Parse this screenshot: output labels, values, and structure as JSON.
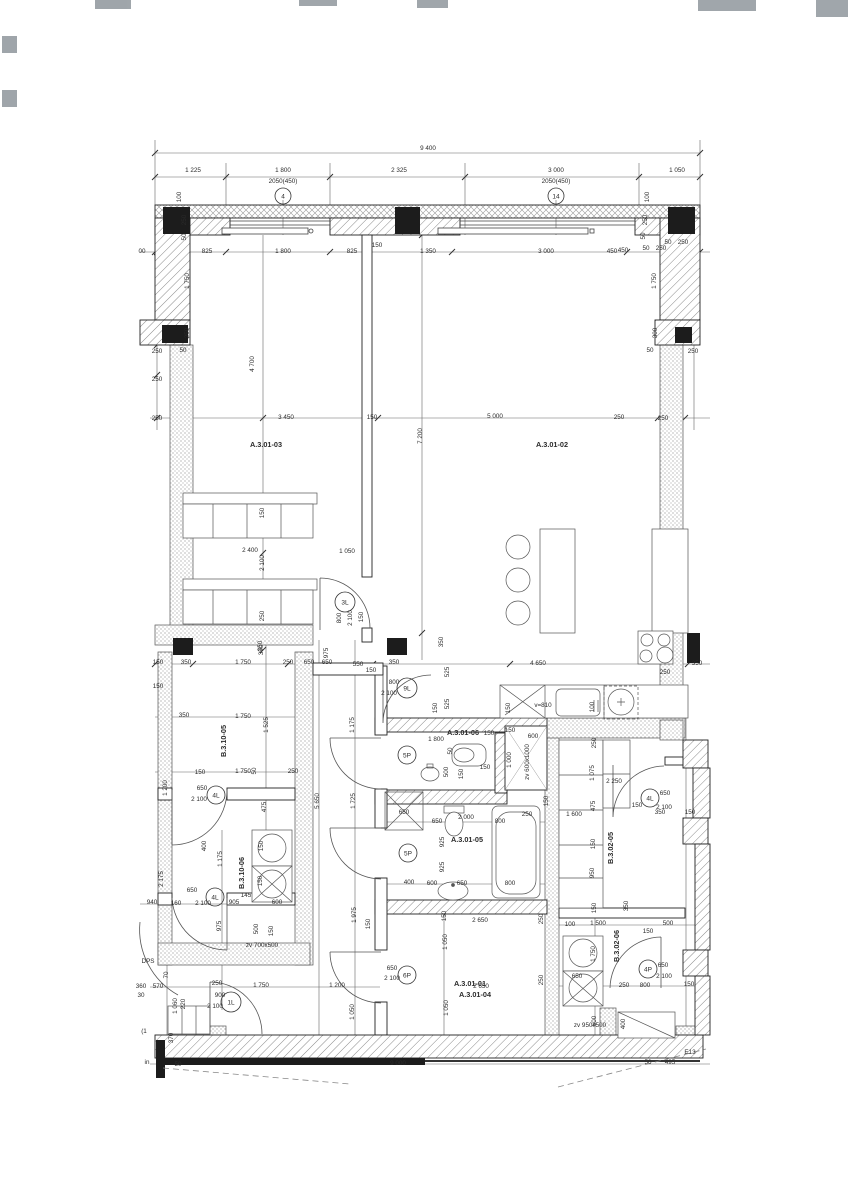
{
  "drawing": {
    "type": "architectural floor plan",
    "overall_width_top": "9 400",
    "overall_width_bottom": "9 000"
  },
  "colors": {
    "line": "#2b2b2b",
    "wall_hatch": "#8a8a8a",
    "column_fill": "#1c1c1c",
    "dim_line": "#555555"
  },
  "window_tags": [
    {
      "t": "4",
      "x": 283,
      "y": 196,
      "r": 8
    },
    {
      "t": "14",
      "x": 556,
      "y": 196,
      "r": 8
    }
  ],
  "door_tags": [
    {
      "t": "3L",
      "x": 345,
      "y": 602,
      "r": 10
    },
    {
      "t": "9L",
      "x": 407,
      "y": 688,
      "r": 10
    },
    {
      "t": "4L",
      "x": 216,
      "y": 795,
      "r": 9
    },
    {
      "t": "4L",
      "x": 215,
      "y": 897,
      "r": 9
    },
    {
      "t": "1L",
      "x": 231,
      "y": 1002,
      "r": 10
    },
    {
      "t": "5P",
      "x": 407,
      "y": 755,
      "r": 9
    },
    {
      "t": "5P",
      "x": 408,
      "y": 853,
      "r": 9
    },
    {
      "t": "6P",
      "x": 407,
      "y": 975,
      "r": 9
    },
    {
      "t": "4L",
      "x": 650,
      "y": 798,
      "r": 9
    },
    {
      "t": "4P",
      "x": 648,
      "y": 969,
      "r": 9
    }
  ],
  "room_labels": [
    {
      "t": "A.3.01-03",
      "x": 266,
      "y": 447
    },
    {
      "t": "A.3.01-02",
      "x": 552,
      "y": 447
    },
    {
      "t": "A.3.01-06",
      "x": 463,
      "y": 735
    },
    {
      "t": "A.3.01-05",
      "x": 467,
      "y": 842
    },
    {
      "t": "A.3.01-04",
      "x": 475,
      "y": 997
    },
    {
      "t": "A.3.01-01",
      "x": 470,
      "y": 986
    },
    {
      "t": "B.3.10-05",
      "x": 226,
      "y": 741,
      "v": true
    },
    {
      "t": "B.3.10-06",
      "x": 244,
      "y": 873,
      "v": true
    },
    {
      "t": "B.3.02-05",
      "x": 613,
      "y": 848,
      "v": true
    },
    {
      "t": "B.3.02-06",
      "x": 619,
      "y": 946,
      "v": true
    }
  ],
  "shaft_labels": [
    {
      "t": "zv 600x1000",
      "x": 529,
      "y": 762,
      "v": true
    },
    {
      "t": "zv 700x500",
      "x": 262,
      "y": 947
    },
    {
      "t": "zv 950x500",
      "x": 590,
      "y": 1027
    },
    {
      "t": "v=810",
      "x": 543,
      "y": 707
    }
  ],
  "dimension_labels": [
    [
      428,
      150,
      "9 400"
    ],
    [
      193,
      172,
      "1 225"
    ],
    [
      283,
      172,
      "1 800"
    ],
    [
      283,
      183,
      "2050(450)"
    ],
    [
      399,
      172,
      "2 325"
    ],
    [
      556,
      172,
      "3 000"
    ],
    [
      556,
      183,
      "2050(450)"
    ],
    [
      677,
      172,
      "1 050"
    ],
    [
      207,
      253,
      "825"
    ],
    [
      283,
      253,
      "1 800"
    ],
    [
      352,
      253,
      "825"
    ],
    [
      377,
      247,
      "150"
    ],
    [
      428,
      253,
      "1 350"
    ],
    [
      546,
      253,
      "3 000"
    ],
    [
      612,
      253,
      "450"
    ],
    [
      646,
      250,
      "50"
    ],
    [
      661,
      250,
      "250"
    ],
    [
      142,
      253,
      "00"
    ],
    [
      181,
      197,
      "100",
      "v"
    ],
    [
      186,
      220,
      "250",
      "v"
    ],
    [
      186,
      237,
      "50",
      "v"
    ],
    [
      189,
      281,
      "1 750",
      "v"
    ],
    [
      189,
      333,
      "250",
      "v"
    ],
    [
      157,
      353,
      "250"
    ],
    [
      183,
      352,
      "50"
    ],
    [
      157,
      381,
      "250"
    ],
    [
      157,
      420,
      "250"
    ],
    [
      649,
      197,
      "100",
      "v"
    ],
    [
      647,
      220,
      "250",
      "v"
    ],
    [
      645,
      236,
      "50",
      "v"
    ],
    [
      668,
      244,
      "50"
    ],
    [
      683,
      244,
      "250"
    ],
    [
      623,
      252,
      "450"
    ],
    [
      656,
      281,
      "1 750",
      "v"
    ],
    [
      657,
      333,
      "300",
      "v"
    ],
    [
      650,
      352,
      "50"
    ],
    [
      693,
      353,
      "250"
    ],
    [
      663,
      420,
      "250"
    ],
    [
      254,
      364,
      "4 700",
      "v"
    ],
    [
      286,
      419,
      "3 450"
    ],
    [
      372,
      419,
      "150"
    ],
    [
      495,
      418,
      "5 000"
    ],
    [
      422,
      436,
      "7 200",
      "v"
    ],
    [
      619,
      419,
      "250"
    ],
    [
      264,
      513,
      "150",
      "v"
    ],
    [
      250,
      552,
      "2 400"
    ],
    [
      264,
      563,
      "2 100",
      "v"
    ],
    [
      347,
      553,
      "1 050"
    ],
    [
      264,
      616,
      "250",
      "v"
    ],
    [
      263,
      650,
      "350",
      "v"
    ],
    [
      341,
      618,
      "800",
      "v"
    ],
    [
      352,
      618,
      "2 100",
      "v"
    ],
    [
      363,
      617,
      "150",
      "v"
    ],
    [
      328,
      653,
      "975",
      "v"
    ],
    [
      309,
      664,
      "650"
    ],
    [
      358,
      666,
      "550"
    ],
    [
      371,
      672,
      "150"
    ],
    [
      394,
      664,
      "350"
    ],
    [
      443,
      642,
      "350",
      "v"
    ],
    [
      449,
      672,
      "525",
      "v"
    ],
    [
      449,
      704,
      "525",
      "v"
    ],
    [
      437,
      708,
      "150",
      "v"
    ],
    [
      354,
      725,
      "1 175",
      "v"
    ],
    [
      394,
      684,
      "800"
    ],
    [
      389,
      695,
      "2 100"
    ],
    [
      538,
      665,
      "4 650"
    ],
    [
      665,
      674,
      "250"
    ],
    [
      697,
      665,
      "350"
    ],
    [
      594,
      707,
      "100",
      "v"
    ],
    [
      510,
      708,
      "150",
      "v"
    ],
    [
      158,
      664,
      "150"
    ],
    [
      186,
      664,
      "350"
    ],
    [
      243,
      664,
      "1 750"
    ],
    [
      288,
      664,
      "250"
    ],
    [
      327,
      664,
      "650"
    ],
    [
      158,
      688,
      "150"
    ],
    [
      262,
      646,
      "350",
      "v"
    ],
    [
      268,
      725,
      "1 525",
      "v"
    ],
    [
      184,
      717,
      "350"
    ],
    [
      243,
      718,
      "1 750"
    ],
    [
      167,
      788,
      "1 200",
      "v"
    ],
    [
      200,
      774,
      "150"
    ],
    [
      243,
      773,
      "1 750"
    ],
    [
      256,
      771,
      "50",
      "v"
    ],
    [
      293,
      773,
      "250"
    ],
    [
      202,
      790,
      "650"
    ],
    [
      199,
      801,
      "2 100"
    ],
    [
      266,
      807,
      "475",
      "v"
    ],
    [
      319,
      801,
      "5 650",
      "v"
    ],
    [
      355,
      801,
      "1 725",
      "v"
    ],
    [
      206,
      846,
      "400",
      "v"
    ],
    [
      222,
      859,
      "1 175",
      "v"
    ],
    [
      263,
      846,
      "150",
      "v"
    ],
    [
      262,
      881,
      "150",
      "v"
    ],
    [
      192,
      892,
      "650"
    ],
    [
      203,
      905,
      "2 100"
    ],
    [
      176,
      905,
      "160"
    ],
    [
      152,
      904,
      "940"
    ],
    [
      234,
      904,
      "905"
    ],
    [
      277,
      904,
      "600"
    ],
    [
      246,
      897,
      "145"
    ],
    [
      163,
      879,
      "2 175",
      "v"
    ],
    [
      221,
      926,
      "975",
      "v"
    ],
    [
      258,
      929,
      "500",
      "v"
    ],
    [
      273,
      931,
      "150",
      "v"
    ],
    [
      148,
      963,
      "DPS"
    ],
    [
      168,
      975,
      "70",
      "v"
    ],
    [
      158,
      988,
      "570"
    ],
    [
      141,
      988,
      "360"
    ],
    [
      141,
      997,
      "30"
    ],
    [
      217,
      985,
      "250"
    ],
    [
      261,
      987,
      "1 750"
    ],
    [
      220,
      997,
      "900"
    ],
    [
      215,
      1008,
      "2 100"
    ],
    [
      337,
      987,
      "1 200"
    ],
    [
      177,
      1006,
      "1 060",
      "v"
    ],
    [
      185,
      1004,
      "220",
      "v"
    ],
    [
      356,
      915,
      "1 975",
      "v"
    ],
    [
      370,
      924,
      "150",
      "v"
    ],
    [
      354,
      1012,
      "1 050",
      "v"
    ],
    [
      392,
      970,
      "650"
    ],
    [
      392,
      980,
      "2 100"
    ],
    [
      446,
      916,
      "150",
      "v"
    ],
    [
      480,
      922,
      "2 650"
    ],
    [
      447,
      942,
      "1 050",
      "v"
    ],
    [
      543,
      919,
      "250",
      "v"
    ],
    [
      481,
      988,
      "2 650"
    ],
    [
      448,
      1008,
      "1 050",
      "v"
    ],
    [
      543,
      980,
      "250",
      "v"
    ],
    [
      436,
      741,
      "1 800"
    ],
    [
      489,
      735,
      "150"
    ],
    [
      510,
      732,
      "150"
    ],
    [
      533,
      738,
      "600"
    ],
    [
      452,
      751,
      "50",
      "v"
    ],
    [
      448,
      772,
      "500",
      "v"
    ],
    [
      463,
      774,
      "150",
      "v"
    ],
    [
      485,
      769,
      "150"
    ],
    [
      511,
      760,
      "1 000",
      "v"
    ],
    [
      404,
      814,
      "650"
    ],
    [
      437,
      823,
      "650"
    ],
    [
      466,
      819,
      "2 000"
    ],
    [
      527,
      816,
      "250"
    ],
    [
      500,
      823,
      "800"
    ],
    [
      444,
      842,
      "925",
      "v"
    ],
    [
      444,
      867,
      "925",
      "v"
    ],
    [
      409,
      884,
      "400"
    ],
    [
      432,
      885,
      "600"
    ],
    [
      462,
      885,
      "650"
    ],
    [
      510,
      885,
      "800"
    ],
    [
      548,
      801,
      "150",
      "v"
    ],
    [
      574,
      816,
      "1 600"
    ],
    [
      596,
      743,
      "250",
      "v"
    ],
    [
      594,
      773,
      "1 075",
      "v"
    ],
    [
      614,
      783,
      "2 250"
    ],
    [
      595,
      806,
      "475",
      "v"
    ],
    [
      665,
      795,
      "650"
    ],
    [
      664,
      809,
      "2 100"
    ],
    [
      637,
      807,
      "150"
    ],
    [
      660,
      814,
      "350"
    ],
    [
      690,
      814,
      "150"
    ],
    [
      595,
      844,
      "150",
      "v"
    ],
    [
      594,
      873,
      "950",
      "v"
    ],
    [
      596,
      908,
      "150",
      "v"
    ],
    [
      628,
      906,
      "350",
      "v"
    ],
    [
      570,
      926,
      "100"
    ],
    [
      598,
      925,
      "1 500"
    ],
    [
      668,
      925,
      "500"
    ],
    [
      648,
      933,
      "150"
    ],
    [
      595,
      954,
      "1 750",
      "v"
    ],
    [
      577,
      978,
      "650"
    ],
    [
      624,
      987,
      "250"
    ],
    [
      645,
      987,
      "800"
    ],
    [
      689,
      986,
      "150"
    ],
    [
      663,
      967,
      "650"
    ],
    [
      664,
      978,
      "2 100"
    ],
    [
      596,
      1021,
      "500",
      "v"
    ],
    [
      625,
      1024,
      "400",
      "v"
    ],
    [
      398,
      1065,
      "9 000"
    ],
    [
      173,
      1038,
      "370",
      "v"
    ],
    [
      144,
      1033,
      "(1"
    ],
    [
      147,
      1064,
      "in"
    ],
    [
      178,
      1066,
      "50"
    ],
    [
      648,
      1064,
      "50"
    ],
    [
      670,
      1064,
      "495"
    ],
    [
      690,
      1054,
      "E13"
    ]
  ]
}
